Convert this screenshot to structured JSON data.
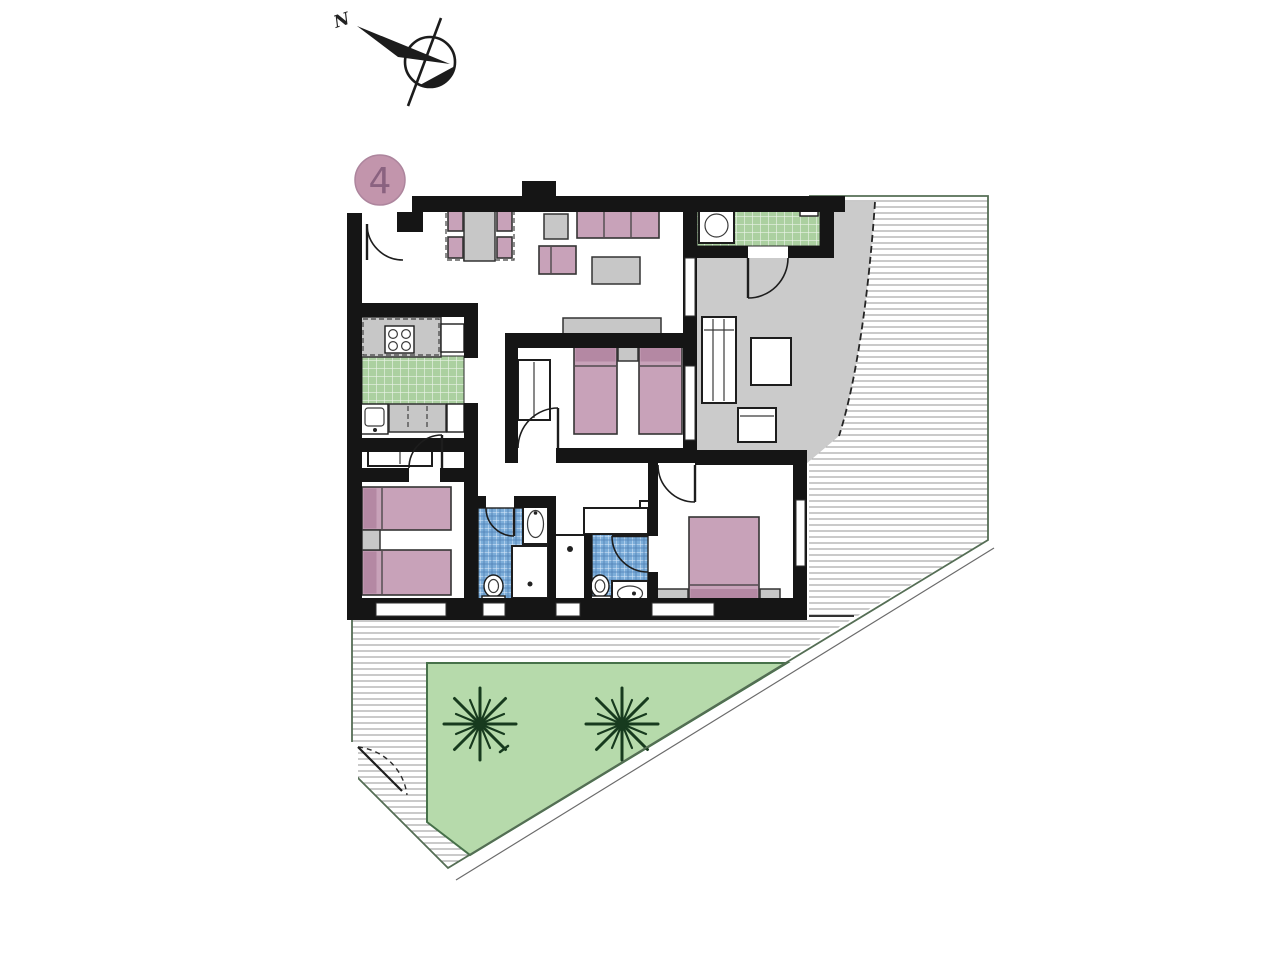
{
  "compass": {
    "label": "N"
  },
  "unit_badge": {
    "number": "4"
  },
  "palette": {
    "wall": "#151515",
    "ink": "#1d1d1d",
    "pink": "#c8a2b9",
    "pink_dark": "#b488a3",
    "gray_furn": "#c7c7c7",
    "terr_gray": "#cbcbcb",
    "tile_green_base": "#abd0a0",
    "tile_green_line": "#e9f3e6",
    "tile_blue_base": "#7cadd9",
    "tile_blue_line": "#dceafb",
    "tile_blue_line2": "#4f80b5",
    "garden": "#b6daab",
    "garden_stroke": "#47714a",
    "palm": "#173a1e",
    "hatch_line": "#a0a0a0",
    "boundary": "#556e55",
    "badge_fill": "#c295ac",
    "badge_stroke": "#ad859d",
    "badge_text": "#8a6280"
  }
}
